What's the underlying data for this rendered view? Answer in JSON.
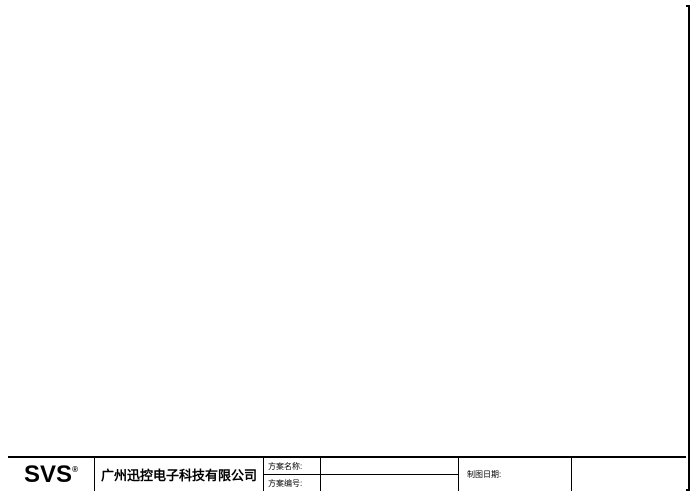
{
  "sheet": {
    "logo": "SVS",
    "logo_reg": "®",
    "company": "广州迅控电子科技有限公司",
    "titleblock": {
      "scheme_name_label": "方案名称:",
      "scheme_name_value": "",
      "scheme_no_label": "方案编号:",
      "scheme_no_value": "",
      "date_label": "制图日期:",
      "date_value": ""
    }
  },
  "colors": {
    "vga": "#8ed7d7",
    "video": "#f2bde6",
    "control": "#a9dda9",
    "mic": "#f0b3c7",
    "power": "#e79a9a",
    "audio": "#c6c3ea",
    "speaker": "#c9ecc9",
    "yellow": "#ece5a6"
  },
  "legend": {
    "items": [
      {
        "label": "电脑VGA线",
        "key": "vga"
      },
      {
        "label": "复合视频线",
        "key": "video"
      },
      {
        "label": "通讯控制线",
        "key": "control"
      },
      {
        "label": "话筒音频线",
        "key": "mic"
      },
      {
        "label": "电源线",
        "key": "power"
      },
      {
        "label": "音频线",
        "key": "audio"
      },
      {
        "label": "音箱线",
        "key": "speaker"
      }
    ]
  },
  "devices": {
    "wireless_panel": {
      "name": "无线触摸屏",
      "model": "SV WZ2000"
    },
    "panel_receiver": {
      "name": "触摸屏接收器",
      "model": "RECV-200"
    },
    "pc": {
      "name": "电脑",
      "model": "(远程视频软件)"
    },
    "capture_card": {
      "line1": "高清视频",
      "line2": "采集卡"
    },
    "central_control": {
      "name": "中央控制系统",
      "model": "SV9000"
    },
    "gooseneck_mics": {
      "name": "鹅颈话筒×2",
      "model": "MS-600"
    },
    "dvd": {
      "name": "DVD机"
    },
    "matrix": {
      "name": "混合矩阵",
      "model": "MS-RGB0404"
    },
    "hd_host": {
      "name": "高清混插主机",
      "model": "SV-HD0401"
    },
    "conf_host": {
      "name": "会议主机",
      "model": "MS-800P"
    },
    "feedback": {
      "name": "反馈抑制器",
      "model": "FB1100"
    },
    "wireless_mic": {
      "name": "无线话筒",
      "model": "WD3500"
    },
    "mixer": {
      "name": "调音台",
      "model": "8DX/4B1"
    },
    "audio_processor": {
      "name": "音频处理器",
      "model": "DA206"
    },
    "cameras": {
      "name": "高清遥控摄像头",
      "model": "HD1000"
    },
    "delegate_units": {
      "name": "发言单元×6",
      "model": "MS-900A/B"
    },
    "laptop": {
      "name": "笔记本"
    },
    "power_sequencer": {
      "name": "电源时序器",
      "model": "SV-PW8"
    },
    "power_controller": {
      "name": "电源控制器",
      "model": "SV-SP8"
    },
    "projector": {
      "name": "投影机"
    },
    "lcd_tv": {
      "name": "液晶电视×2"
    },
    "screen": {
      "name": "电动幕布"
    },
    "power_note": {
      "text": "会议主机、反馈抑制器、调音台、音频处理器、功放等电源"
    },
    "main_amp": {
      "name": "主扩声功放",
      "model": "CS2000"
    },
    "main_speakers": {
      "name": "主扩声音箱",
      "model": "T-12"
    },
    "aux_amp": {
      "name": "辅助扩声功放",
      "model": "CSD200"
    },
    "aux_speakers": {
      "name": "辅助扩声音箱",
      "model": "K-8"
    }
  }
}
